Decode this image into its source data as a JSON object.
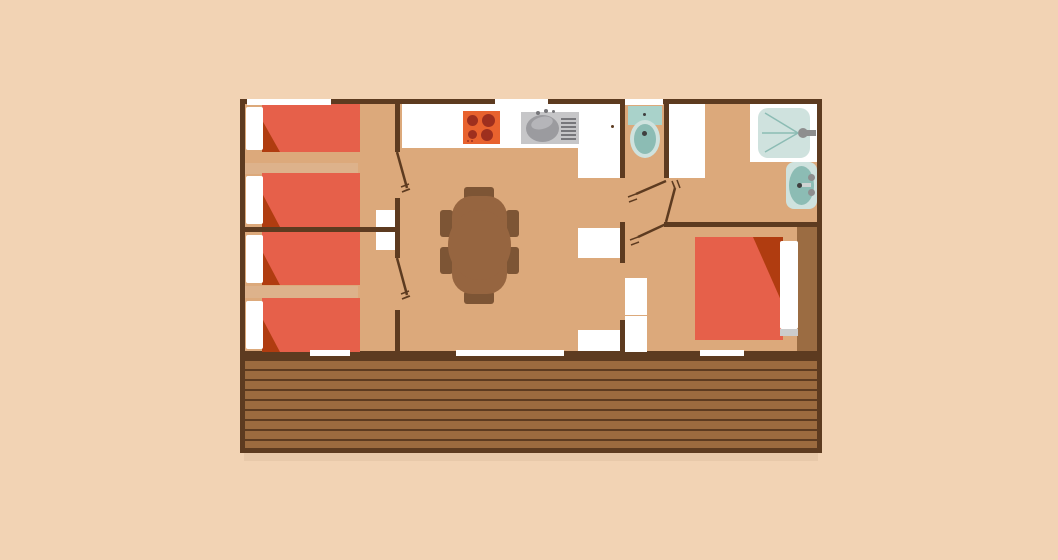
{
  "scene": {
    "type": "floor-plan",
    "description": "Top-view floor plan of a cottage / mobile home with front wooden deck",
    "rooms": [
      {
        "name": "bedroom-left-top",
        "fixtures": [
          "single-bed",
          "single-bed",
          "closet"
        ]
      },
      {
        "name": "bedroom-left-bottom",
        "fixtures": [
          "single-bed",
          "single-bed",
          "closet"
        ]
      },
      {
        "name": "kitchen-living-room",
        "fixtures": [
          "stove",
          "kitchen-sink",
          "counter",
          "dining-table",
          "six-chairs",
          "cabinet",
          "cabinet"
        ]
      },
      {
        "name": "wc",
        "fixtures": [
          "toilet"
        ]
      },
      {
        "name": "bathroom",
        "fixtures": [
          "shower",
          "washbasin",
          "closet"
        ]
      },
      {
        "name": "bedroom-right",
        "fixtures": [
          "double-bed",
          "wardrobe",
          "closet"
        ]
      },
      {
        "name": "deck",
        "fixtures": [
          "wood-planks"
        ]
      }
    ],
    "door_count": 5,
    "window_count": 6
  },
  "colors": {
    "background": "#f2d3b4",
    "floor": "#dca97b",
    "divider_light": "#ddb28b",
    "wall": "#5d3b20",
    "deck_plank": "#9c6b3f",
    "deck_gap": "#5d3b20",
    "deck_shadow": "#e8c9aa",
    "bed_red": "#e6604a",
    "bed_fold": "#b03c10",
    "pillow": "#ffffff",
    "pillow_shadow": "#cccccc",
    "table": "#966540",
    "chair": "#7d5535",
    "stove_body": "#e8622e",
    "stove_burner": "#9e2f1e",
    "sink_body": "#c6c6c8",
    "sink_basin": "#9b9b9f",
    "sink_highlight": "#b5b5b9",
    "sink_detail": "#77777b",
    "counter_white": "#ffffff",
    "fixture_teal": "#a9d2ca",
    "fixture_teal_light": "#cfe2de",
    "fixture_teal_dark": "#8cbcb4",
    "fixture_dot": "#3f3f3f",
    "metal_gray": "#8e8e8e",
    "faucet_light": "#cfd4d3",
    "wardrobe": "#9b6c42"
  }
}
